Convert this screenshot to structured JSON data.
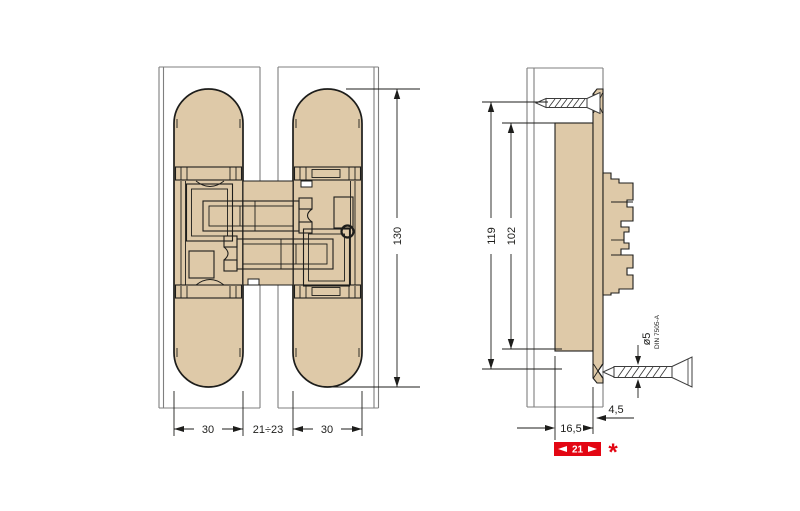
{
  "front_view": {
    "height": "130",
    "width_left": "30",
    "width_gap": "21÷23",
    "width_right": "30"
  },
  "side_view": {
    "hole_spacing": "119",
    "body_length": "102",
    "mortise_depth": "16,5",
    "face_offset": "4,5",
    "total_depth": "21",
    "footnote": "*",
    "screw_diameter": "ø5",
    "screw_standard": "DIN 7505-A"
  },
  "colors": {
    "body": "#dec9a8",
    "outline": "#1d1d1b",
    "panel": "#7f7f7f",
    "dim": "#1d1d1b",
    "screw": "#3c3c3c",
    "highlight": "#e30613",
    "highlight_text": "#ffffff",
    "background": "#ffffff"
  }
}
